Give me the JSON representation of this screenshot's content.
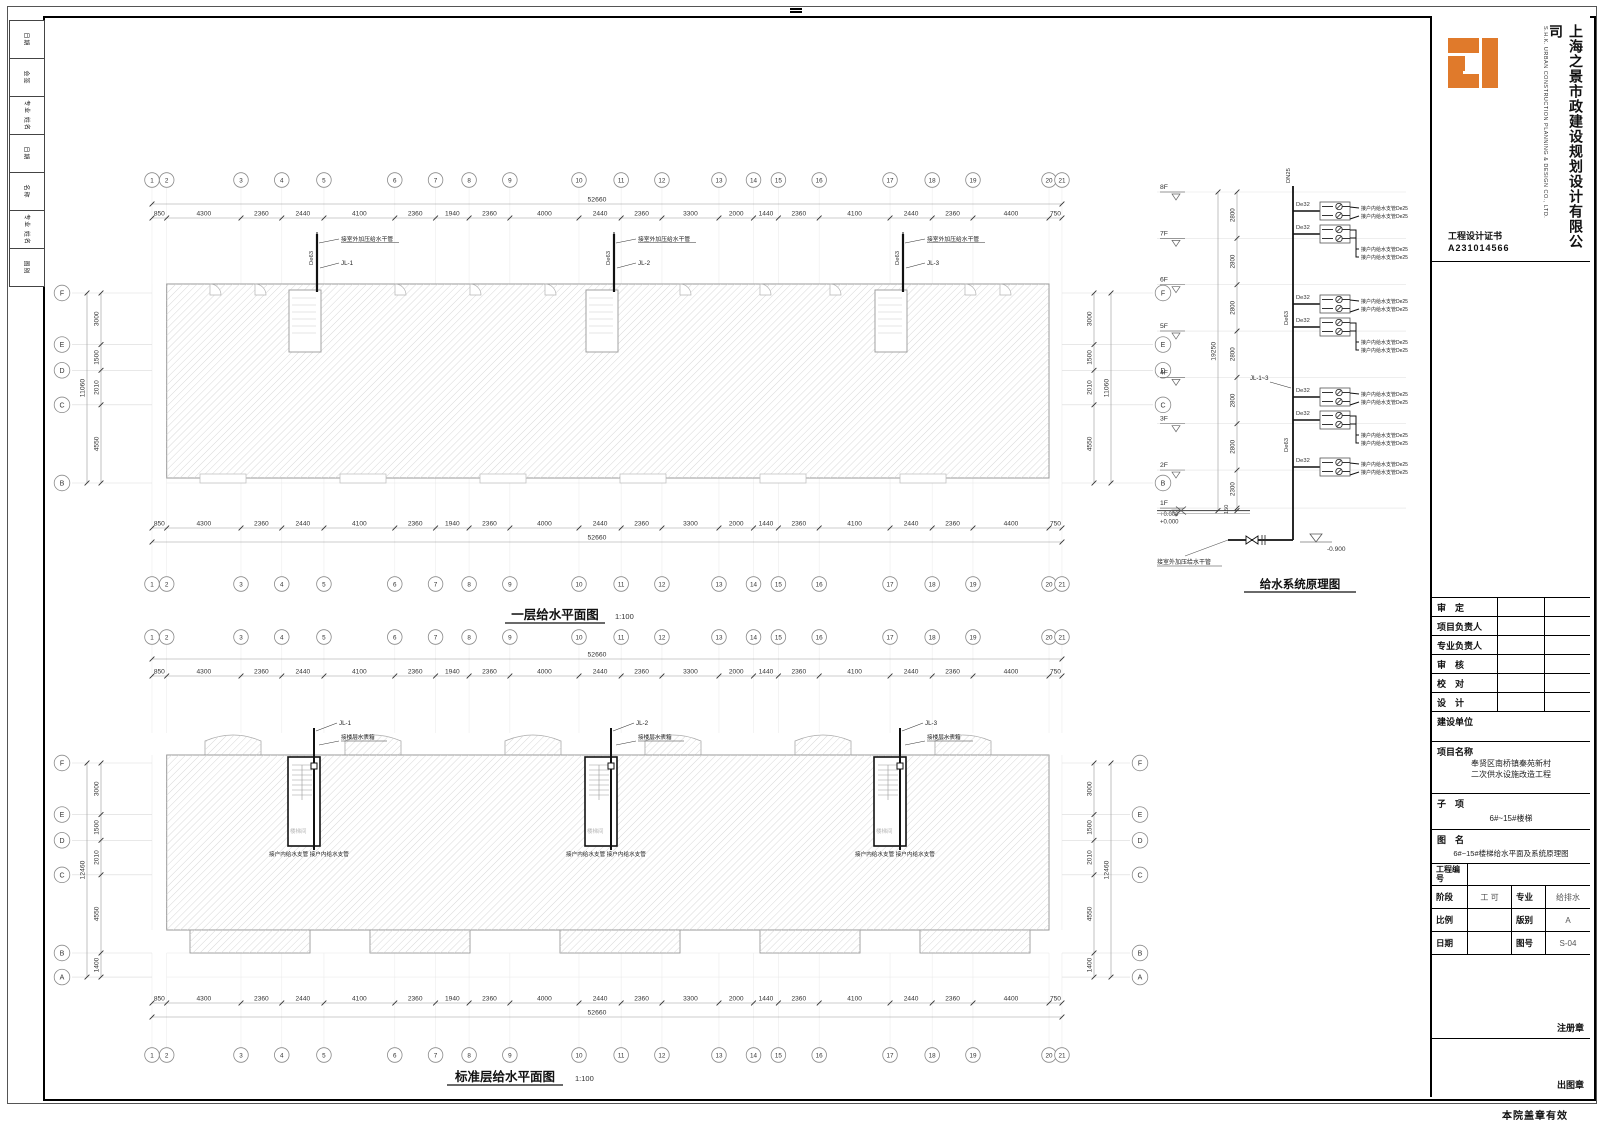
{
  "footer": {
    "valid_note": "本院盖章有效"
  },
  "left_strip": {
    "cells": [
      "日期",
      "会签",
      "专业 姓名",
      "日期",
      "名称",
      "专业 姓名",
      "图别"
    ]
  },
  "titleblock": {
    "company_cn": "上海之景市政建设规划设计有限公司",
    "company_en": "S.H.K. URBAN CONSTRUCTION PLANNING & DESIGN CO., LTD.",
    "cert_label": "工程设计证书",
    "cert_no": "A231014566",
    "sign_rows": [
      "审　定",
      "项目负责人",
      "专业负责人",
      "审　核",
      "校　对",
      "设　计"
    ],
    "build_unit_label": "建设单位",
    "project_label": "项目名称",
    "project_line1": "奉贤区南桥镇秦苑新村",
    "project_line2": "二次供水设施改造工程",
    "subitem_label": "子　项",
    "subitem_value": "6#~15#楼梯",
    "drawing_label": "图　名",
    "drawing_name": "6#~15#楼梯给水平面及系统原理图",
    "project_no_label": "工程编号",
    "stage_label": "阶段",
    "stage_value": "工 可",
    "discipline_label": "专业",
    "discipline_value": "给排水",
    "scale_label": "比例",
    "scale_value": "",
    "version_label": "版别",
    "version_value": "A",
    "date_label": "日期",
    "date_value": "",
    "figno_label": "图号",
    "figno_value": "S-04",
    "seal_register": "注册章",
    "seal_issue": "出图章"
  },
  "plans": {
    "grid_labels": [
      "1",
      "2",
      "3",
      "4",
      "5",
      "6",
      "7",
      "8",
      "9",
      "10",
      "11",
      "12",
      "13",
      "14",
      "15",
      "16",
      "17",
      "18",
      "19",
      "20",
      "21"
    ],
    "h_dims": [
      "850",
      "4300",
      "2360",
      "2440",
      "4100",
      "2360",
      "1940",
      "2360",
      "4000",
      "2440",
      "2360",
      "3300",
      "2000",
      "1440",
      "2360",
      "4100",
      "2440",
      "2360",
      "4400",
      "750"
    ],
    "h_total": "52660",
    "plan1": {
      "title": "一层给水平面图",
      "scale": "1:100",
      "letters": [
        "F",
        "E",
        "D",
        "C",
        "B"
      ],
      "v_dims": [
        "3000",
        "1500",
        "2010",
        "4550"
      ],
      "v_total": "11060",
      "riser_labels": [
        "JL-1",
        "JL-2",
        "JL-3"
      ],
      "riser_note": "接室外加压给水干管",
      "riser_pipe": "De63"
    },
    "plan2": {
      "title": "标准层给水平面图",
      "scale": "1:100",
      "letters": [
        "F",
        "E",
        "D",
        "C",
        "B",
        "A"
      ],
      "v_dims": [
        "3000",
        "1500",
        "2010",
        "4550",
        "1400"
      ],
      "v_total": "12460",
      "riser_labels": [
        "JL-1",
        "JL-2",
        "JL-3"
      ],
      "riser_note": "接楼层水表箱",
      "branch_note": "接户内给水支管 接户内给水支管",
      "room_label": "楼梯间"
    }
  },
  "schematic": {
    "title": "给水系统原理图",
    "floors": [
      "8F",
      "7F",
      "6F",
      "5F",
      "4F",
      "3F",
      "2F",
      "1F"
    ],
    "floor_dims": [
      "2800",
      "2800",
      "2800",
      "2800",
      "2800",
      "2800",
      "2300"
    ],
    "base_dim": "150",
    "total_dim": "19250",
    "top_pipe": "DN25",
    "riser_pipe": "De63",
    "branch_pipe": "De32",
    "branch_label": "接户内给水支管De25",
    "riser_ref": "JL-1~3",
    "level_zero": "+0.000",
    "level_base": "-0.900",
    "bottom_note": "接室外加压给水干管"
  }
}
